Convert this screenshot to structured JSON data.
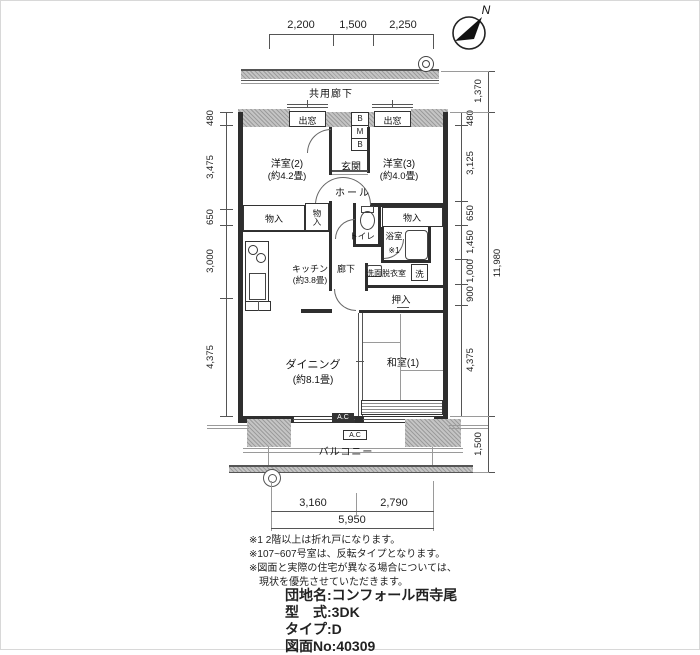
{
  "compass": {
    "north": "N"
  },
  "dims": {
    "top": [
      "2,200",
      "1,500",
      "2,250"
    ],
    "left": [
      "480",
      "3,475",
      "650",
      "3,000",
      "4,375"
    ],
    "right_inner": [
      "480",
      "3,125",
      "650",
      "1,450",
      "1,000",
      "900",
      "4,375"
    ],
    "right_outer_top": "1,370",
    "right_outer_total": "11,980",
    "right_outer_bottom": "1,500",
    "bottom": [
      "3,160",
      "2,790"
    ],
    "bottom_total": "5,950"
  },
  "plan": {
    "corridor": "共用廊下",
    "balcony": "バルコニー",
    "bay_window_left": "出窓",
    "bay_window_right": "出窓",
    "meter_box": [
      "B",
      "M",
      "B"
    ],
    "entrance": "玄関",
    "hall": "ホール",
    "hallway": "廊下",
    "western_room_2": {
      "name": "洋室(2)",
      "size": "(約4.2畳)"
    },
    "western_room_3": {
      "name": "洋室(3)",
      "size": "(約4.0畳)"
    },
    "japanese_room_1": {
      "name": "和室(1)"
    },
    "dining": {
      "name": "ダイニング",
      "size": "(約8.1畳)"
    },
    "kitchen": {
      "name": "キッチン",
      "size": "(約3.8畳)"
    },
    "closet_left": "物入",
    "closet_left_vertical": "物入",
    "closet_right": "物入",
    "toilet": "トイレ",
    "bath": "浴室",
    "bath_note": "※1",
    "washroom": "洗面脱衣室",
    "laundry": "洗",
    "oshiire": "押入",
    "ac_upper": "A.C",
    "ac_lower": "A.C"
  },
  "notes": [
    "※1 2階以上は折れ戸になります。",
    "※107~607号室は、反転タイプとなります。",
    "※図面と実際の住宅が異なる場合については、",
    "現状を優先させていただきます。"
  ],
  "info": {
    "rows": [
      {
        "label": "団地名",
        "sep": ":",
        "value": "コンフォール西寺尾"
      },
      {
        "label": "型　式",
        "sep": ":",
        "value": "3DK"
      },
      {
        "label": "タイプ",
        "sep": ":",
        "value": "D"
      },
      {
        "label": "図面No",
        "sep": ":",
        "value": "40309"
      }
    ]
  }
}
